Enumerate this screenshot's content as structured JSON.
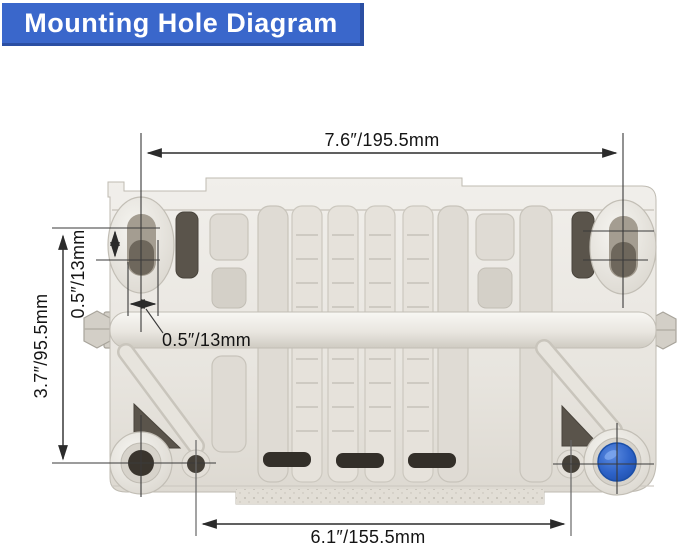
{
  "banner": {
    "title": "Mounting Hole Diagram"
  },
  "colors": {
    "banner_bg": "#3A67CB",
    "banner_border": "#2B4FA3",
    "banner_text": "#FFFFFF",
    "dim_line": "#2b2b2b",
    "dim_text": "#141414",
    "plug_blue": "#2E63C8"
  },
  "diagram": {
    "dimensions": {
      "overall_width": {
        "label": "7.6″/195.5mm"
      },
      "slot_offset": {
        "label": "0.5″/13mm"
      },
      "mount_height": {
        "label": "3.7″/95.5mm"
      },
      "slot_width": {
        "label": "0.5″/13mm"
      },
      "hole_spacing": {
        "label": "6.1″/155.5mm"
      }
    }
  }
}
